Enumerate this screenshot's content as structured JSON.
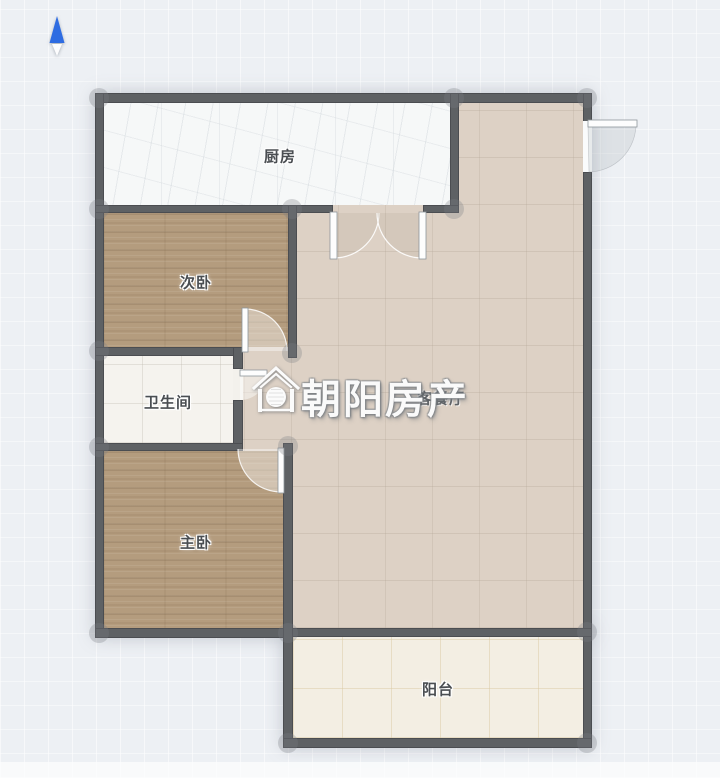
{
  "north_indicator": {
    "icon": "north-arrow",
    "direction": "up"
  },
  "rooms": [
    {
      "id": "kitchen",
      "label": "厨房"
    },
    {
      "id": "secondary-bedroom",
      "label": "次卧"
    },
    {
      "id": "bathroom",
      "label": "卫生间"
    },
    {
      "id": "master-bedroom",
      "label": "主卧"
    },
    {
      "id": "living-dining",
      "label": "客餐厅"
    },
    {
      "id": "balcony",
      "label": "阳台"
    }
  ],
  "watermark": {
    "brand_text": "朝阳房产",
    "logo_icon": "house-sun-logo"
  },
  "colors": {
    "background": "#edf0f4",
    "wall": "#5e6164",
    "wood_floor": "#b49c7e",
    "living_floor": "#ddd1c5",
    "kitchen_floor": "#f6f8f8",
    "bathroom_floor": "#f5f3ee",
    "balcony_floor": "#f3eee3",
    "north_arrow": "#2e6ce2",
    "label_text": "#4a4e52",
    "watermark_text": "#fafafa"
  }
}
